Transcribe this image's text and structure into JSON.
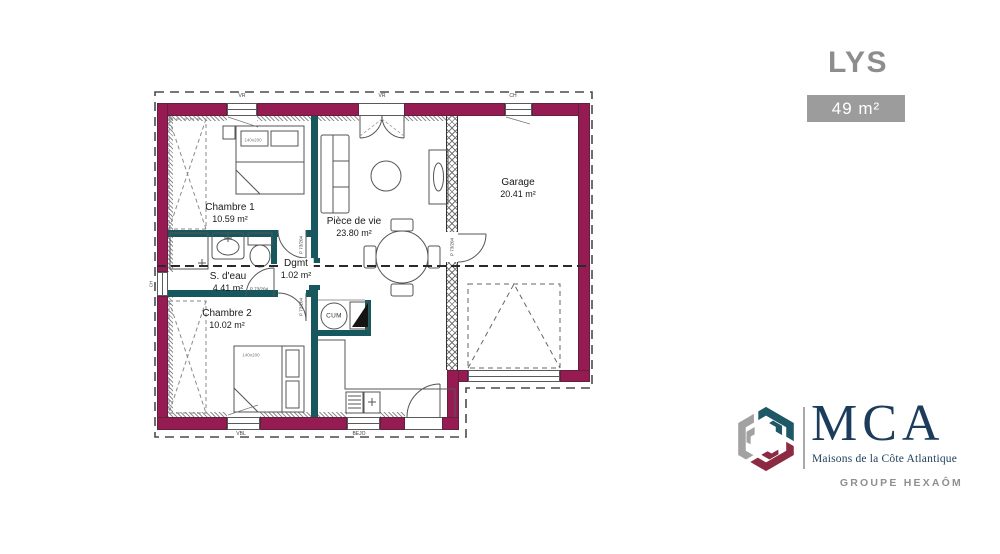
{
  "header": {
    "model_name": "LYS",
    "area_badge": "49 m²"
  },
  "branding": {
    "company": "MCA",
    "tagline": "Maisons de la Côte Atlantique",
    "group": "GROUPE HEXAÔM",
    "colors": {
      "navy": "#1c3c5c",
      "red": "#8c2a42",
      "gray": "#a2a2a2",
      "teal": "#1e5766"
    }
  },
  "floor_plan": {
    "colors": {
      "exterior_wall": "#971b53",
      "interior_wall": "#17585e"
    },
    "rooms": [
      {
        "id": "chambre1",
        "name": "Chambre 1",
        "area": "10.59 m²"
      },
      {
        "id": "piece_de_vie",
        "name": "Pièce de vie",
        "area": "23.80 m²"
      },
      {
        "id": "garage",
        "name": "Garage",
        "area": "20.41 m²"
      },
      {
        "id": "s_deau",
        "name": "S. d'eau",
        "area": "4.41 m²"
      },
      {
        "id": "dgmt",
        "name": "Dgmt",
        "area": "1.02 m²"
      },
      {
        "id": "chambre2",
        "name": "Chambre 2",
        "area": "10.02 m²"
      }
    ],
    "labels": {
      "door": "P 73/204",
      "bed": "140x200",
      "water_heater": "CUM",
      "window_vr": "VR",
      "window_garage": "CH",
      "window_bottom_left": "VBL",
      "window_bottom_mid": "BEJO",
      "window_bath": "CH"
    }
  }
}
